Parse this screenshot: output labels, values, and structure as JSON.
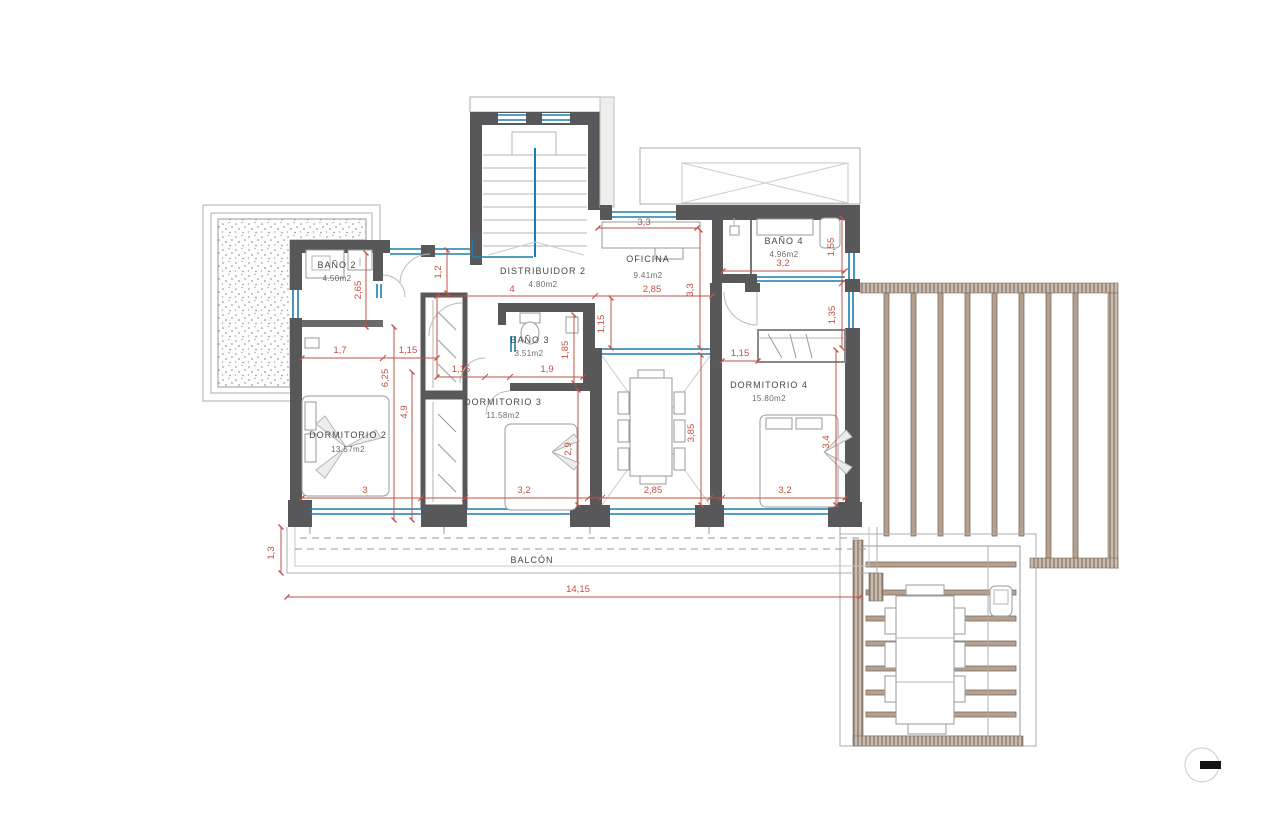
{
  "rooms": {
    "bano2": {
      "name": "BAÑO 2",
      "area": "4.50m2"
    },
    "distribuidor": {
      "name": "DISTRIBUIDOR 2",
      "area": "4.80m2"
    },
    "oficina": {
      "name": "OFICINA",
      "area": "9.41m2"
    },
    "bano4": {
      "name": "BAÑO 4",
      "area": "4.96m2"
    },
    "bano3": {
      "name": "BAÑO 3",
      "area": "3.51m2"
    },
    "dorm2": {
      "name": "DORMITORIO 2",
      "area": "13.57m2"
    },
    "dorm3": {
      "name": "DORMITORIO 3",
      "area": "11.58m2"
    },
    "dorm4": {
      "name": "DORMITORIO 4",
      "area": "15.80m2"
    },
    "balcon": {
      "name": "BALCÓN"
    }
  },
  "dims": {
    "top_33": "3,3",
    "hall_4": "4",
    "oficina_285": "2,85",
    "bano2_17": "1,7",
    "hall_115a": "1,15",
    "bano3_115": "1,15",
    "bano3_19": "1,9",
    "dorm4_115": "1,15",
    "bano4_32": "3,2",
    "dorm2_3": "3",
    "dorm3_32": "3,2",
    "void_285": "2,85",
    "dorm4_32": "3,2",
    "total_1415": "14,15",
    "v_12": "1,2",
    "v_265": "2,65",
    "v_625": "6,25",
    "v_49": "4,9",
    "v_185": "1,85",
    "v_115": "1,15",
    "v_33": "3,3",
    "v_155": "1,55",
    "v_135": "1,35",
    "v_29": "2,9",
    "v_385": "3,85",
    "v_34": "3,4",
    "v_13": "1,3"
  },
  "colors": {
    "wall": "#58585a",
    "window": "#1a7fae",
    "dimension": "#c25044",
    "beam": "#b3a08f"
  }
}
